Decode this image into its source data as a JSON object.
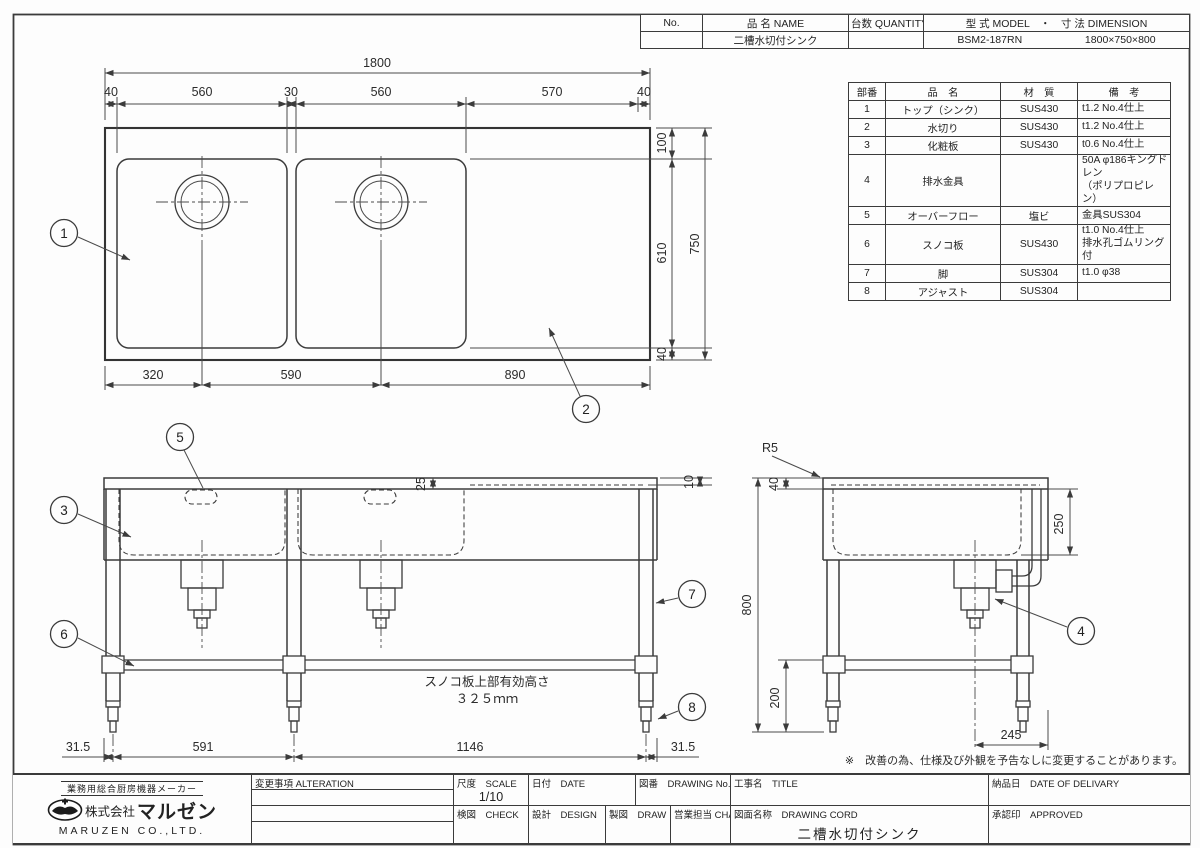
{
  "header_table": {
    "col_no": "No.",
    "col_name": "品 名  NAME",
    "col_quantity": "台数  QUANTITY",
    "col_model_dimension": "型 式  MODEL　・　寸 法  DIMENSION",
    "name_value": "二槽水切付シンク",
    "model_value": "BSM2-187RN",
    "dimension_value": "1800×750×800"
  },
  "parts_table": {
    "col_no": "部番",
    "col_name": "品　名",
    "col_material": "材　質",
    "col_note": "備　考",
    "rows": [
      {
        "no": "1",
        "name": "トップ（シンク）",
        "material": "SUS430",
        "note": "t1.2 No.4仕上"
      },
      {
        "no": "2",
        "name": "水切り",
        "material": "SUS430",
        "note": "t1.2 No.4仕上"
      },
      {
        "no": "3",
        "name": "化粧板",
        "material": "SUS430",
        "note": "t0.6 No.4仕上"
      },
      {
        "no": "4",
        "name": "排水金具",
        "material": "",
        "note": "50A φ186キングドレン\n（ポリプロピレン）"
      },
      {
        "no": "5",
        "name": "オーバーフロー",
        "material": "塩ビ",
        "note": "金具SUS304"
      },
      {
        "no": "6",
        "name": "スノコ板",
        "material": "SUS430",
        "note": "t1.0 No.4仕上\n排水孔ゴムリング付"
      },
      {
        "no": "7",
        "name": "脚",
        "material": "SUS304",
        "note": "t1.0 φ38"
      },
      {
        "no": "8",
        "name": "アジャスト",
        "material": "SUS304",
        "note": ""
      }
    ]
  },
  "top_view": {
    "dim_overall_width": "1800",
    "dims_top": [
      "40",
      "560",
      "30",
      "560",
      "570",
      "40"
    ],
    "dims_right": [
      "100",
      "610",
      "40"
    ],
    "dim_overall_depth": "750",
    "dims_bottom": [
      "320",
      "590",
      "890"
    ]
  },
  "front_view": {
    "dim_backsplash": "25",
    "dim_edge": "10",
    "snoko_note_line1": "スノコ板上部有効高さ",
    "snoko_note_line2": "３２５ｍｍ",
    "dims_bottom": [
      "31.5",
      "591",
      "1146",
      "31.5"
    ]
  },
  "side_view": {
    "radius_label": "R5",
    "dim_top_rail": "40",
    "dim_overall_height": "800",
    "dim_bowl_depth": "250",
    "dim_leg_bottom": "200",
    "dim_drain_offset": "245"
  },
  "balloons": {
    "b1": "1",
    "b2": "2",
    "b3": "3",
    "b4": "4",
    "b5": "5",
    "b6": "6",
    "b7": "7",
    "b8": "8"
  },
  "disclaimer": "※　改善の為、仕様及び外観を予告なしに変更することがあります。",
  "title_block": {
    "maker_tagline": "業務用総合厨房機器メーカー",
    "company_prefix": "株式会社",
    "company_name": "マルゼン",
    "company_en": "MARUZEN CO.,LTD.",
    "alteration_label": "変更事項  ALTERATION",
    "scale_label": "尺度　SCALE",
    "scale_value": "1/10",
    "date_label": "日付　DATE",
    "drawing_no_label": "図番　DRAWING No.",
    "title_label": "工事名　TITLE",
    "delivery_label": "納品日　DATE OF DELIVARY",
    "check_label": "検図　CHECK",
    "design_label": "設計　DESIGN",
    "draw_label": "製図　DRAW",
    "charge_label": "営業担当  CHARGE",
    "drawing_name_label": "図面名称　DRAWING CORD",
    "drawing_name_value": "二槽水切付シンク",
    "approved_label": "承認印　APPROVED"
  }
}
